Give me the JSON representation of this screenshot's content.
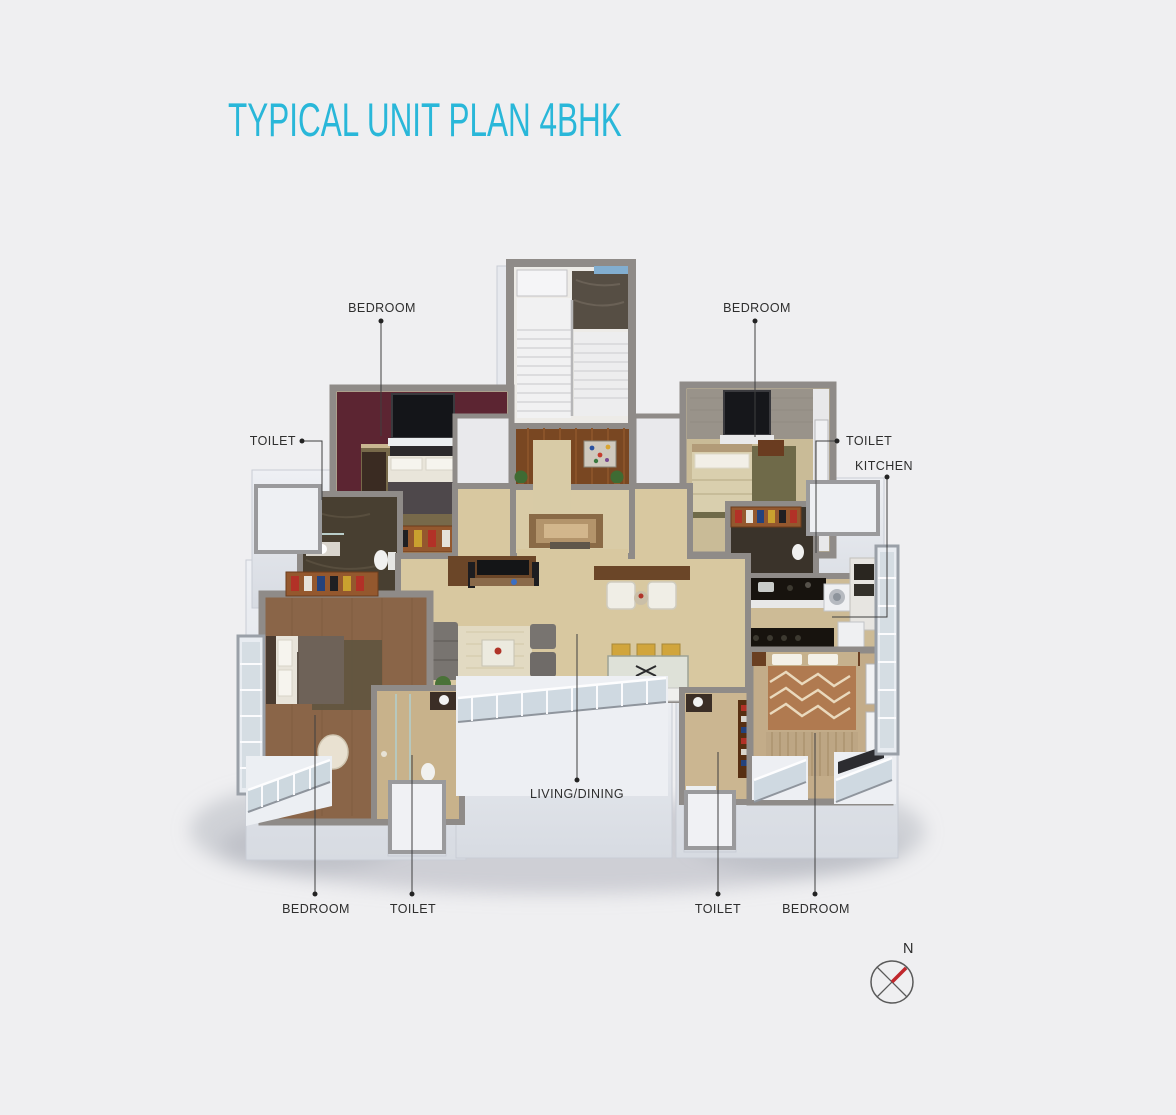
{
  "title": "TYPICAL UNIT PLAN 4BHK",
  "annotations": {
    "bedroom_top_left": "BEDROOM",
    "bedroom_top_right": "BEDROOM",
    "toilet_left": "TOILET",
    "toilet_right": "TOILET",
    "kitchen": "KITCHEN",
    "living_dining": "LIVING/DINING",
    "bedroom_bottom_left": "BEDROOM",
    "toilet_bottom_left": "TOILET",
    "toilet_bottom_right": "TOILET",
    "bedroom_bottom_right": "BEDROOM"
  },
  "compass": {
    "north_label": "N"
  },
  "colors": {
    "accent_title": "#29b7d9",
    "background": "#efeff1",
    "label_text": "#2e2e2e",
    "leader_line": "#3f3f3f",
    "compass_needle": "#c0272d",
    "wall_gray": "#8f8b88",
    "living_floor": "#d8c8a0",
    "wood_floor": "#8a6548",
    "maroon_wall": "#5c2532"
  }
}
